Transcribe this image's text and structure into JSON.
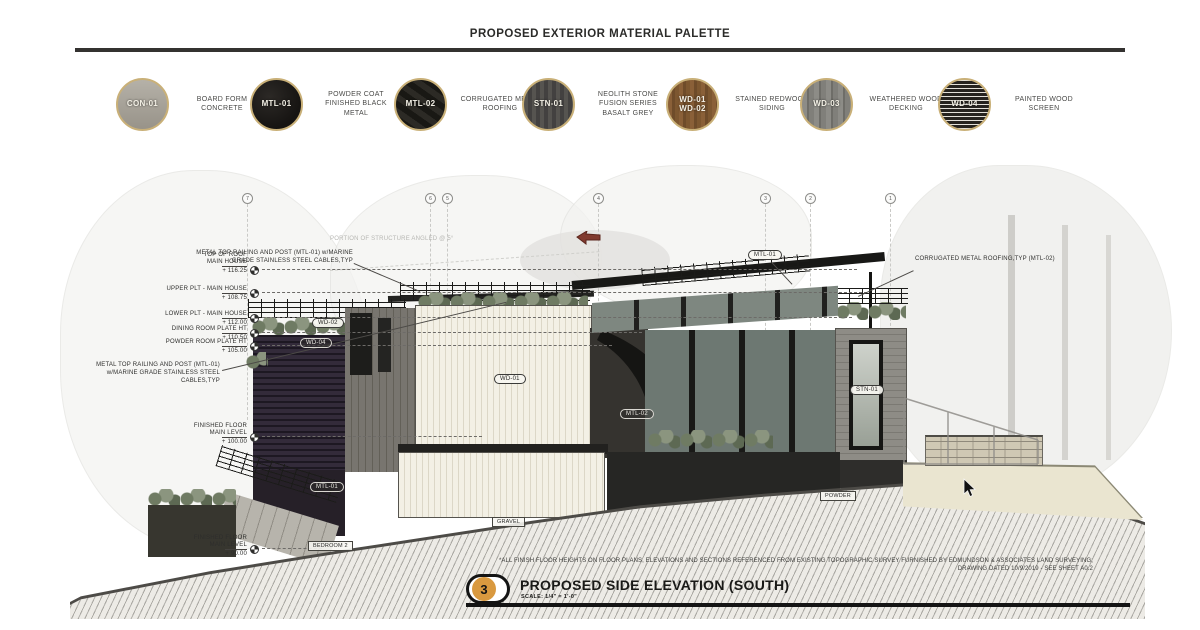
{
  "header": {
    "title": "PROPOSED EXTERIOR MATERIAL PALETTE"
  },
  "colors": {
    "accent_orange": "#d9993f",
    "ink": "#141414",
    "earth_tan": "#eae5d0"
  },
  "palette": {
    "materials": [
      {
        "code": "CON-01",
        "code2": "",
        "label": "BOARD FORM CONCRETE"
      },
      {
        "code": "MTL-01",
        "code2": "",
        "label": "POWDER COAT FINISHED BLACK METAL"
      },
      {
        "code": "MTL-02",
        "code2": "",
        "label": "CORRUGATED METAL ROOFING"
      },
      {
        "code": "STN-01",
        "code2": "",
        "label": "NEOLITH STONE FUSION SERIES BASALT GREY"
      },
      {
        "code": "WD-01",
        "code2": "WD-02",
        "label": "STAINED REDWOOD SIDING"
      },
      {
        "code": "WD-03",
        "code2": "",
        "label": "WEATHERED WOOD DECKING"
      },
      {
        "code": "WD-04",
        "code2": "",
        "label": "PAINTED WOOD SCREEN"
      }
    ]
  },
  "drawing": {
    "grid": [
      "7",
      "6",
      "5",
      "4",
      "3",
      "2",
      "1"
    ],
    "datums": [
      {
        "line1": "TOP OF ROOF",
        "line2": "MAIN HOUSE",
        "value": "+ 116.25"
      },
      {
        "line1": "UPPER PLT - MAIN HOUSE",
        "line2": "",
        "value": "+ 108.75"
      },
      {
        "line1": "LOWER PLT - MAIN HOUSE",
        "line2": "",
        "value": "+ 112.00"
      },
      {
        "line1": "DINING ROOM PLATE HT",
        "line2": "",
        "value": "+ 110.50"
      },
      {
        "line1": "POWDER ROOM PLATE HT",
        "line2": "",
        "value": "+ 105.00"
      },
      {
        "line1": "FINISHED FLOOR",
        "line2": "MAIN LEVEL",
        "value": "+ 100.00"
      },
      {
        "line1": "FINISHED FLOOR",
        "line2": "MAIN LEVEL",
        "value": "+ 90.00"
      }
    ],
    "callouts": {
      "railing": "METAL TOP RAILING AND POST (MTL-01) w/MARINE GRADE STAINLESS STEEL CABLES,TYP",
      "roofing": "CORRUGATED METAL ROOFING,TYP (MTL-02)",
      "angled": "PORTION OF STRUCTURE ANGLED @ 5°"
    },
    "tags": [
      {
        "text": "MTL-01"
      },
      {
        "text": "WD-02"
      },
      {
        "text": "WD-04"
      },
      {
        "text": "WD-01"
      },
      {
        "text": "MTL-02"
      },
      {
        "text": "STN-01"
      },
      {
        "text": "MTL-01"
      }
    ],
    "boxes": [
      {
        "text": "GRAVEL"
      },
      {
        "text": "BEDROOM 2"
      },
      {
        "text": "POWDER"
      }
    ]
  },
  "notes": {
    "line1": "*ALL FINISH FLOOR HEIGHTS ON FLOOR PLANS, ELEVATIONS AND SECTIONS REFERENCED FROM EXISTING TOPOGRAPHIC SURVEY FURNISHED BY EDMUNDSON & ASSOCIATES LAND SURVEYING;",
    "line2": "DRAWING DATED 10/9/2019 - SEE SHEET A0.2"
  },
  "titleblock": {
    "number": "3",
    "title": "PROPOSED SIDE ELEVATION (SOUTH)",
    "scale": "SCALE: 1/4\" = 1'-0\""
  }
}
